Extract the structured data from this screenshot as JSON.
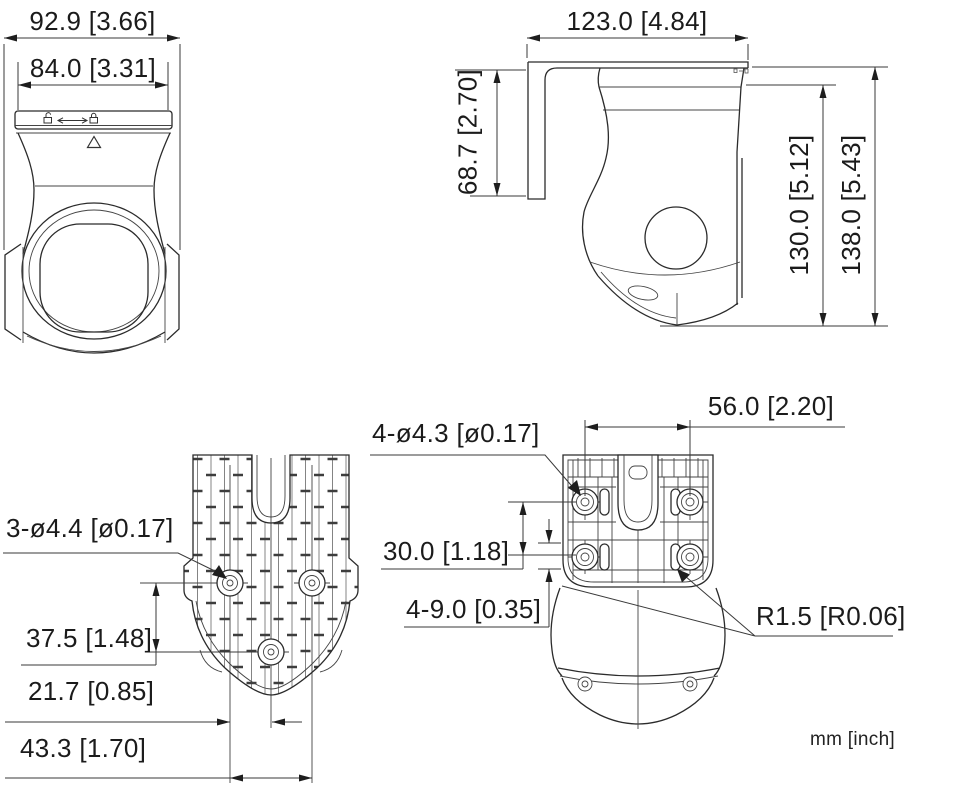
{
  "drawing": {
    "title": "camera-dimensional-drawing",
    "units": "mm [inch]",
    "colors": {
      "line": "#2b2b2b",
      "dim": "#3a3a3a",
      "text": "#1b1b1b",
      "background": "#ffffff"
    },
    "front": {
      "outer_width": "92.9 [3.66]",
      "inner_width": "84.0 [3.31]"
    },
    "side": {
      "depth": "123.0 [4.84]",
      "bracket_height": "68.7 [2.70]",
      "body_height": "130.0 [5.12]",
      "overall_height": "138.0 [5.43]"
    },
    "back": {
      "holes": "3-ø4.4 [ø0.17]",
      "vertical_spacing": "37.5 [1.48]",
      "horizontal_inner": "21.7 [0.85]",
      "horizontal_outer": "43.3 [1.70]"
    },
    "plate": {
      "hole_spacing_horizontal": "56.0 [2.20]",
      "holes": "4-ø4.3 [ø0.17]",
      "hole_spacing_vertical": "30.0 [1.18]",
      "slots": "4-9.0 [0.35]",
      "corner_radius": "R1.5 [R0.06]"
    },
    "icons": {
      "cap_left": "unlock-icon",
      "cap_middle": "slide-arrow-icon",
      "cap_right": "lock-icon",
      "body_marker": "triangle-marker-icon"
    }
  }
}
